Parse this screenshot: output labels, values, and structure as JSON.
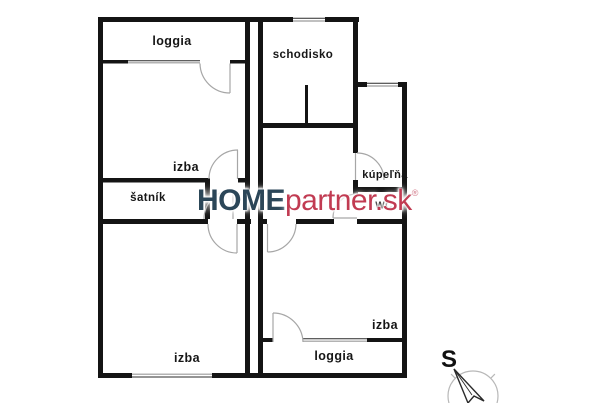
{
  "floorplan": {
    "rooms": [
      {
        "id": "loggia-top",
        "label": "loggia"
      },
      {
        "id": "schodisko",
        "label": "schodisko"
      },
      {
        "id": "izba-top",
        "label": "izba"
      },
      {
        "id": "satnik",
        "label": "šatník"
      },
      {
        "id": "kupelna",
        "label": "kúpeľňa"
      },
      {
        "id": "wc",
        "label": "WC"
      },
      {
        "id": "izba-bottom-left",
        "label": "izba"
      },
      {
        "id": "izba-bottom-right",
        "label": "izba"
      },
      {
        "id": "loggia-bottom",
        "label": "loggia"
      }
    ],
    "compass": {
      "north_label": "S"
    },
    "watermark": {
      "brand_primary": "HOME",
      "brand_secondary": "partner.sk",
      "registered_mark": "®",
      "primary_color": "#2b4658",
      "secondary_color": "#c13b52"
    },
    "colors": {
      "wall": "#141414",
      "door_symbol": "#a6a6a6",
      "window_symbol": "#9a9a9a"
    }
  }
}
